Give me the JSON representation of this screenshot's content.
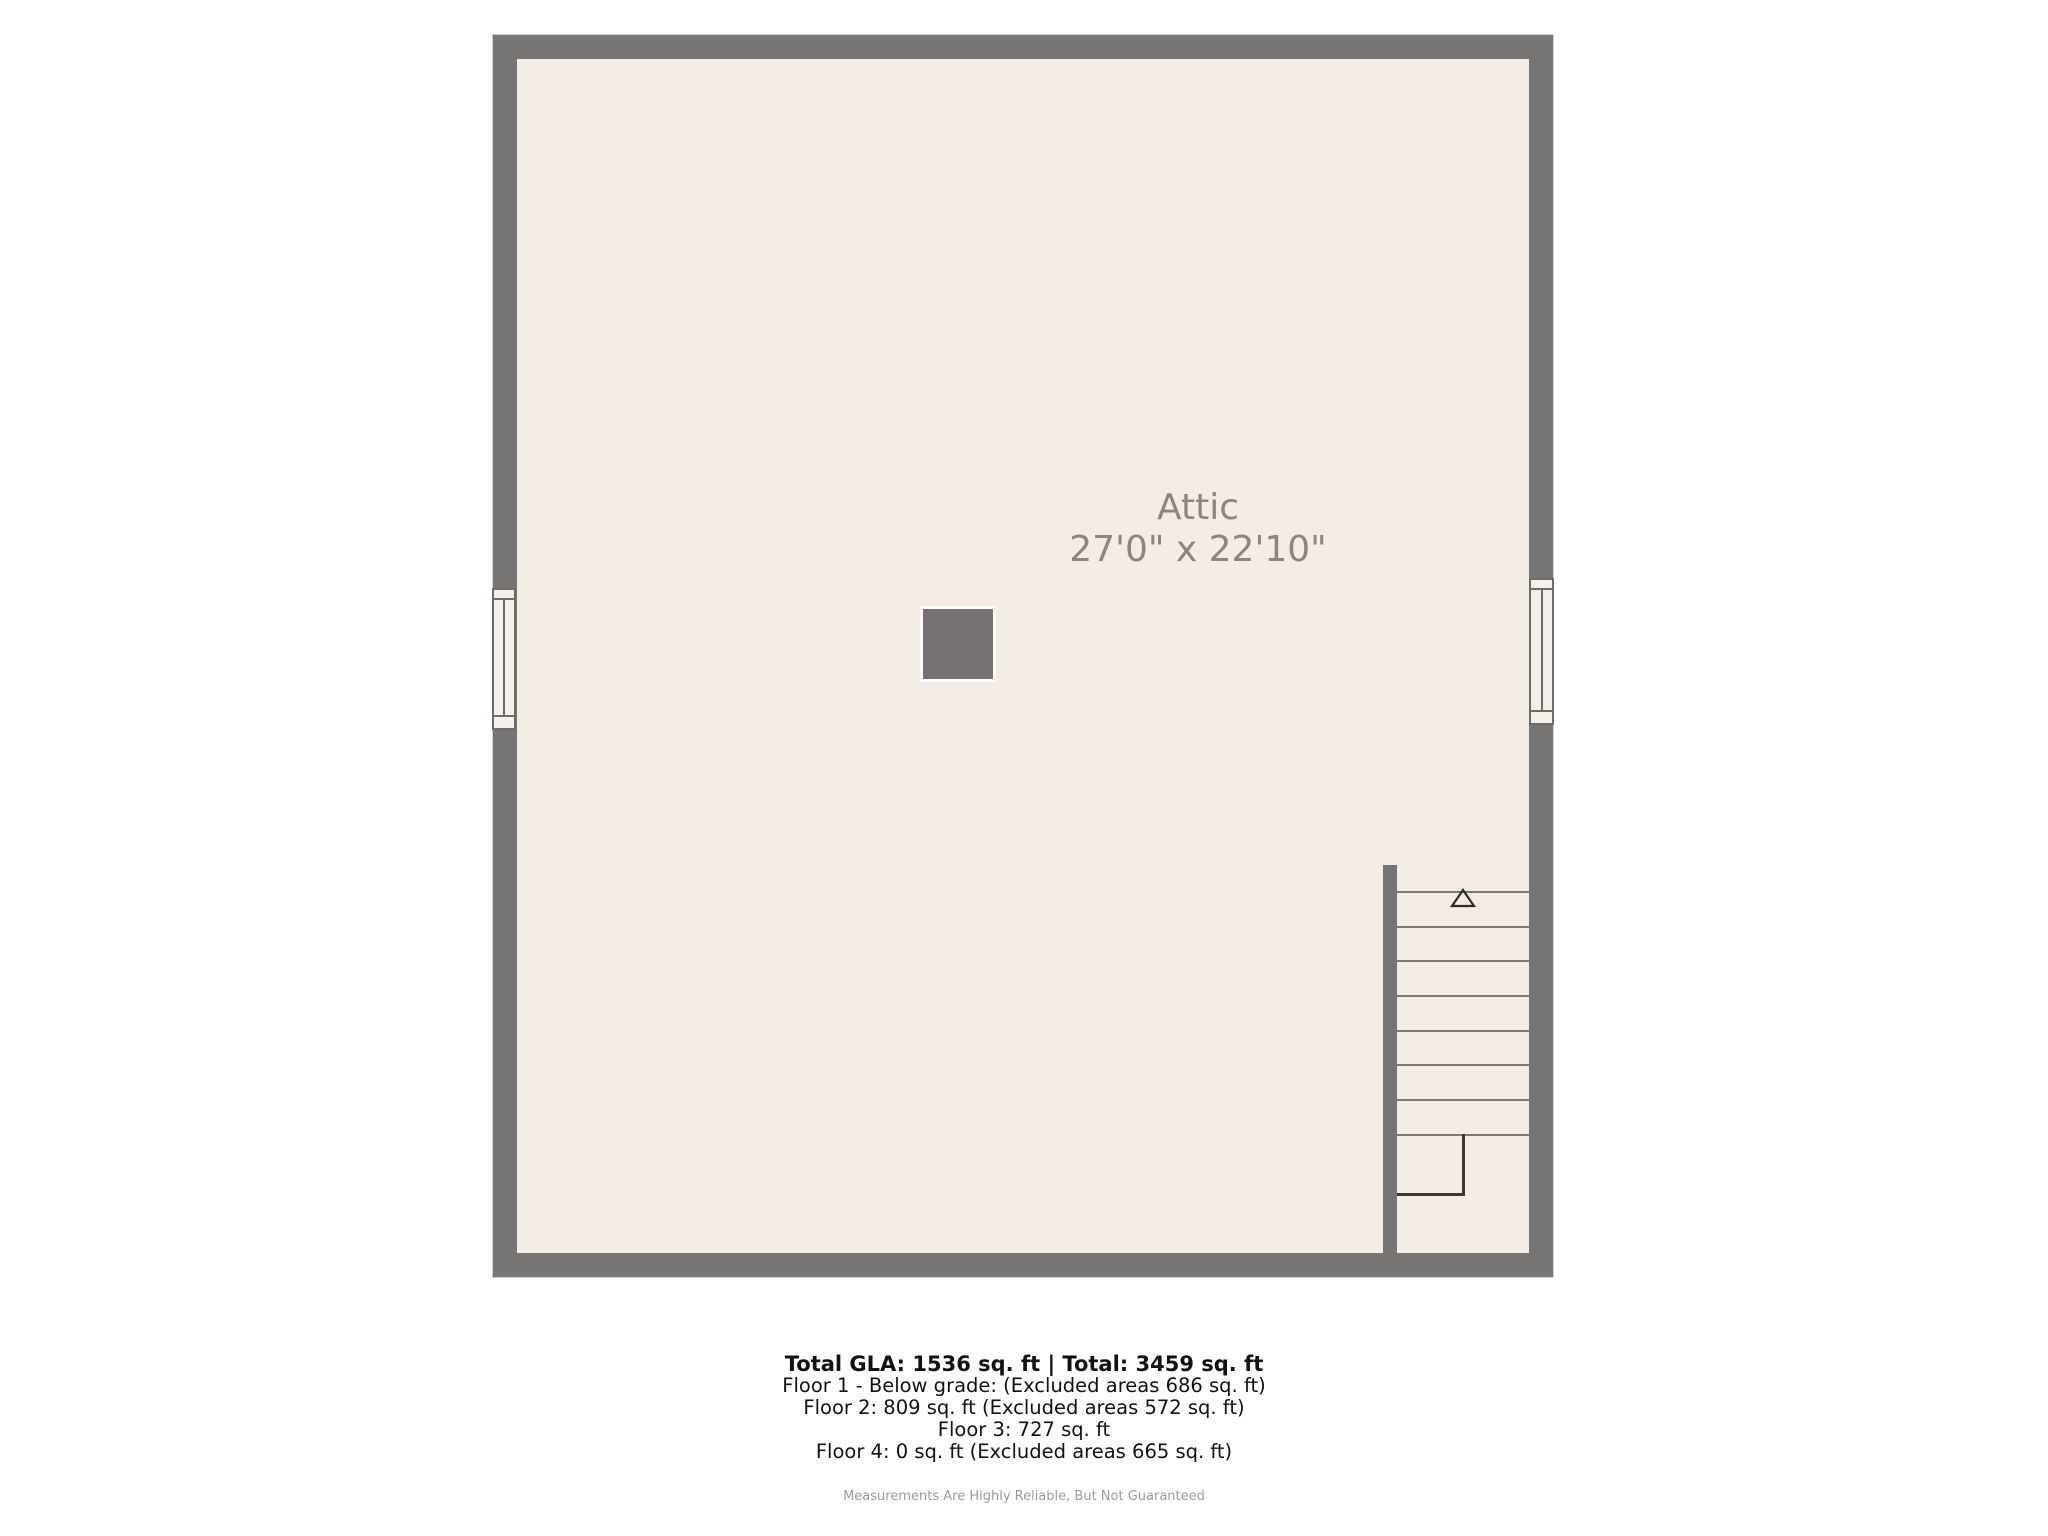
{
  "floor_plan": {
    "room": {
      "label": "Attic",
      "dimensions": "27'0\" x 22'10\""
    },
    "features": {
      "chimney": "solid gray square near room center",
      "window_left": "double-hung window symbol in left wall",
      "window_right": "double-hung window symbol in right wall",
      "staircase": {
        "location": "bottom-right corner",
        "treads": 8,
        "landing": "L-shaped winder at bottom",
        "direction_icon": "up-arrow"
      }
    }
  },
  "summary": {
    "total": "Total GLA: 1536 sq. ft | Total: 3459 sq. ft",
    "floors": [
      "Floor 1 - Below grade: (Excluded areas 686 sq. ft)",
      "Floor 2: 809 sq. ft (Excluded areas 572 sq. ft)",
      "Floor 3: 727 sq. ft",
      "Floor 4: 0 sq. ft (Excluded areas 665 sq. ft)"
    ],
    "disclaimer": "Measurements Are Highly Reliable, But Not Guaranteed"
  },
  "colors": {
    "wall": "#777573",
    "floor": "#f4ede6",
    "chimney": "#767271",
    "window_fill": "#f6f0ea",
    "window_line": "#6e6b69",
    "tread_line": "#7c7a78",
    "landing_line": "#3a3734",
    "room_text": "#8b8682",
    "summary_text": "#111111",
    "disclaimer_text": "#9b9b9b",
    "background": "#ffffff"
  }
}
